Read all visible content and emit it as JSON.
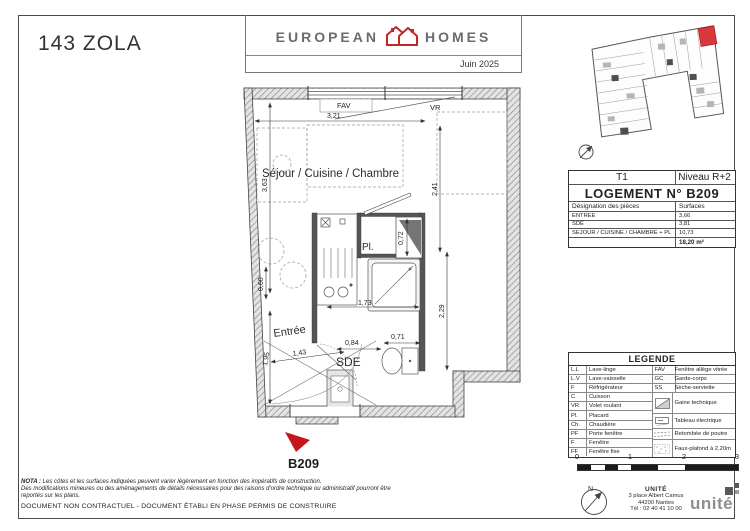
{
  "page": {
    "title": "143 ZOLA",
    "date": "Juin 2025"
  },
  "brand": {
    "word_left": "EUROPEAN",
    "word_right": "HOMES"
  },
  "unit_table": {
    "type": "T1",
    "level": "Niveau R+2",
    "title": "LOGEMENT N° B209",
    "col_designation": "Désignation des pièces",
    "col_surfaces": "Surfaces",
    "rows": [
      {
        "name": "ENTREE",
        "surface": "3,66"
      },
      {
        "name": "SDE",
        "surface": "3,81"
      },
      {
        "name": "SEJOUR / CUISINE / CHAMBRE + PL",
        "surface": "10,73"
      }
    ],
    "total": "18,20 m²"
  },
  "legend": {
    "title": "LEGENDE",
    "left": [
      {
        "abbr": "L.L",
        "label": "Lave-linge"
      },
      {
        "abbr": "L.V",
        "label": "Lave-vaisselle"
      },
      {
        "abbr": "F",
        "label": "Réfrigérateur"
      },
      {
        "abbr": "C",
        "label": "Cuisson"
      },
      {
        "abbr": "VR",
        "label": "Volet roulant"
      },
      {
        "abbr": "Pl.",
        "label": "Placard"
      },
      {
        "abbr": "Ch.",
        "label": "Chaudière"
      },
      {
        "abbr": "PF",
        "label": "Porte fenêtre"
      },
      {
        "abbr": "F",
        "label": "Fenêtre"
      },
      {
        "abbr": "FF",
        "label": "Fenêtre fixe"
      }
    ],
    "right_text": [
      {
        "abbr": "FAV",
        "label": "Fenêtre allège vitrée"
      },
      {
        "abbr": "GC",
        "label": "Garde-corps"
      },
      {
        "abbr": "SS",
        "label": "Sèche-serviette"
      }
    ],
    "right_symbols": [
      {
        "label": "Gaine technique"
      },
      {
        "label": "Tableau électrique"
      },
      {
        "label": "Retombée de poutre"
      },
      {
        "label": "Faux-plafond à 2,20m"
      }
    ]
  },
  "plan": {
    "unit_number": "B209",
    "rooms": {
      "main": "Séjour / Cuisine / Chambre",
      "entry": "Entrée",
      "bathroom": "SDE",
      "closet": "Pl."
    },
    "windows": {
      "fav": "FAV",
      "vr": "VR"
    },
    "dims": {
      "w_top": "3,21",
      "h_right": "2,41",
      "h_left": "3,63",
      "h_left2": "0,60",
      "h_closet": "0,72",
      "w_mid": "1,73",
      "h_mid": "2,29",
      "d_entry": "1,43",
      "w_sink": "0,84",
      "w_wc": "0,71",
      "h_bottom": "1,95"
    }
  },
  "scale_bar": {
    "ticks": [
      "0",
      "1",
      "2",
      "3"
    ]
  },
  "compass": {
    "north": "N"
  },
  "architect": {
    "name": "UNITÉ",
    "address_line1": "3 place Albert Camus",
    "address_line2": "44200 Nantes",
    "phone": "Tél : 02 40 41 10 00",
    "logo": "unité"
  },
  "footer": {
    "nota_bold": "NOTA :",
    "nota_line1": " Les côtes et les surfaces indiquées peuvent varier légèrement en fonction des impératifs de construction.",
    "nota_line2": "Des modifications mineures ou des aménagements de détails nécessaires pour des raisons d'ordre technique ou administratif pourront être",
    "nota_line3": "reportés sur les plans.",
    "document_line": "DOCUMENT NON CONTRACTUEL - DOCUMENT ÉTABLI EN PHASE PERMIS DE CONSTRUIRE"
  },
  "colors": {
    "accent": "#C4161C",
    "brand_gray": "#6B6C6F"
  }
}
